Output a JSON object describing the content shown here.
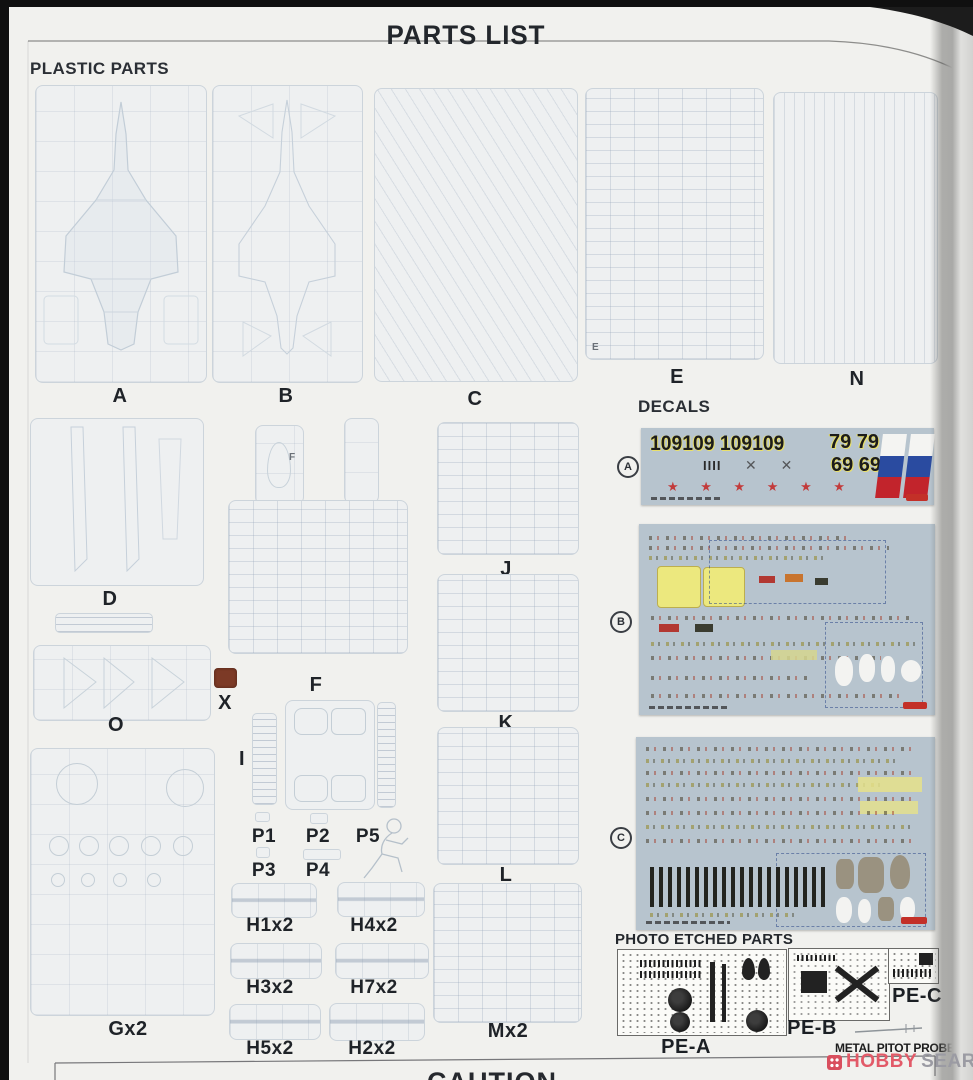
{
  "page": {
    "title": "PARTS LIST",
    "caution_heading": "CAUTION"
  },
  "plastic_parts": {
    "heading": "PLASTIC PARTS",
    "sprues": {
      "a": "A",
      "b": "B",
      "c": "C",
      "e": "E",
      "n": "N",
      "d": "D",
      "o": "O",
      "x": "X",
      "f": "F",
      "i": "I",
      "j": "J",
      "k": "K",
      "l": "L",
      "p1": "P1",
      "p2": "P2",
      "p3": "P3",
      "p4": "P4",
      "p5": "P5",
      "h1": "H1x2",
      "h4": "H4x2",
      "h3": "H3x2",
      "h7": "H7x2",
      "h5": "H5x2",
      "h2": "H2x2",
      "g": "Gx2",
      "m": "Mx2"
    },
    "inner_marks": {
      "f": "F",
      "e": "E"
    }
  },
  "decals": {
    "heading": "DECALS",
    "sheet_a": {
      "marker": "A",
      "numbers_large": "109109 109109",
      "numbers_79": "79 79",
      "numbers_69": "69 69",
      "tally": "IIII",
      "crosses": "✕  ✕",
      "stars": "★ ★ ★ ★ ★ ★"
    },
    "sheet_b": {
      "marker": "B"
    },
    "sheet_c": {
      "marker": "C"
    }
  },
  "photo_etched": {
    "heading": "PHOTO ETCHED PARTS",
    "fret_a": "PE-A",
    "fret_b": "PE-B",
    "fret_c": "PE-C",
    "pitot_label": "METAL PITOT PROBE"
  },
  "watermark": {
    "hobby": "HOBBY",
    "search": "SEARCH"
  },
  "colors": {
    "star_red": "#c23b3b",
    "flag_blue": "#2a4ba0",
    "flag_red": "#c2242c",
    "decal_sheet_bg": "#b7c4ce",
    "x_part_brown": "#7c3a26",
    "watermark_pink": "#e25a68",
    "watermark_grey": "#9b9ba3"
  }
}
